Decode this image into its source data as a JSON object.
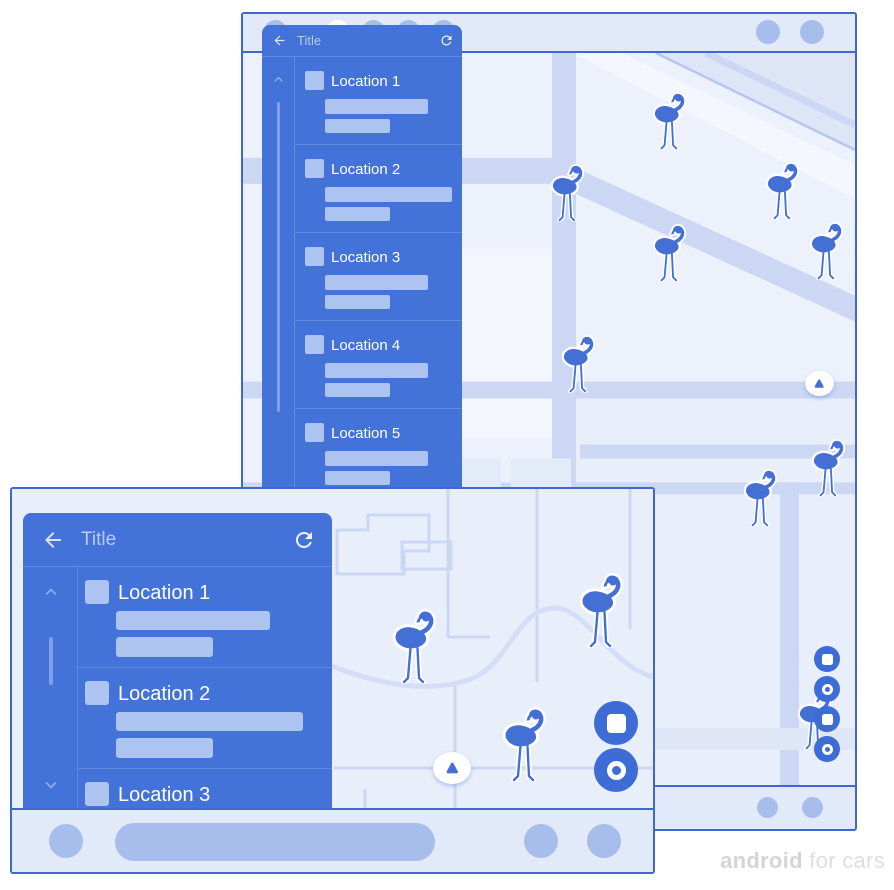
{
  "watermark": {
    "brand": "android",
    "suffix": " for cars"
  },
  "phone": {
    "panel": {
      "title": "Title",
      "items": [
        {
          "label": "Location 1"
        },
        {
          "label": "Location 2"
        },
        {
          "label": "Location 3"
        },
        {
          "label": "Location 4"
        },
        {
          "label": "Location 5"
        }
      ]
    },
    "map": {
      "markers": [
        {
          "x": 410,
          "y": 38
        },
        {
          "x": 308,
          "y": 110
        },
        {
          "x": 523,
          "y": 108
        },
        {
          "x": 410,
          "y": 170
        },
        {
          "x": 567,
          "y": 168
        },
        {
          "x": 319,
          "y": 281
        },
        {
          "x": 501,
          "y": 415
        },
        {
          "x": 569,
          "y": 385
        },
        {
          "x": 555,
          "y": 638
        }
      ]
    }
  },
  "car": {
    "panel": {
      "title": "Title",
      "items": [
        {
          "label": "Location 1"
        },
        {
          "label": "Location 2"
        },
        {
          "label": "Location 3"
        }
      ]
    },
    "map": {
      "markers": [
        {
          "x": 381,
          "y": 119
        },
        {
          "x": 568,
          "y": 83
        },
        {
          "x": 491,
          "y": 217
        }
      ]
    }
  },
  "colors": {
    "accent": "#4372d8",
    "window_border": "#3e68cf",
    "placeholder": "#aec4f0",
    "marker": "#4470d6"
  }
}
